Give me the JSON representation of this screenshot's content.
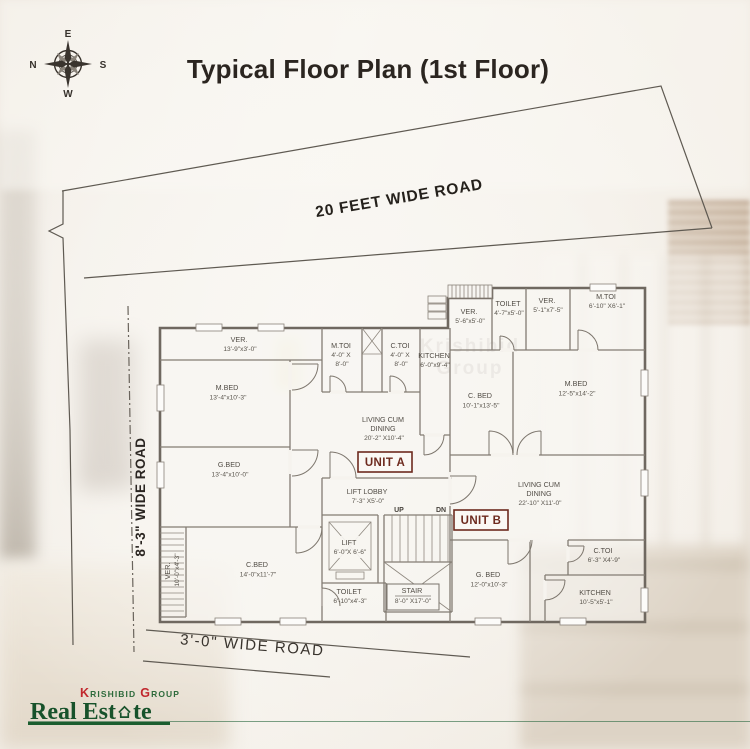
{
  "title": "Typical Floor Plan (1st Floor)",
  "compass": {
    "top": "E",
    "left": "N",
    "right": "S",
    "bottom": "W"
  },
  "roads": {
    "top": "20 FEET WIDE ROAD",
    "left": "8'-3\" WIDE ROAD",
    "bottom": "3'-0\" WIDE ROAD"
  },
  "plan": {
    "unit_a": "UNIT A",
    "unit_b": "UNIT B",
    "up": "UP",
    "dn": "DN",
    "rooms": [
      {
        "lines": [
          "VER.",
          "13'-9\"x3'-0\""
        ]
      },
      {
        "lines": [
          "M.TOI",
          "4'-0\" X",
          "8'-0\""
        ]
      },
      {
        "lines": [
          "C.TOI",
          "4'-0\" X",
          "8'-0\""
        ]
      },
      {
        "lines": [
          "KITCHEN",
          "6'-0\"x9'-4\""
        ]
      },
      {
        "lines": [
          "M.BED",
          "13'-4\"x10'-3\""
        ]
      },
      {
        "lines": [
          "G.BED",
          "13'-4\"x10'-0\""
        ]
      },
      {
        "lines": [
          "VER.",
          "10'-0\"x4'-3\""
        ]
      },
      {
        "lines": [
          "C.BED",
          "14'-0\"x11'-7\""
        ]
      },
      {
        "lines": [
          "TOILET",
          "6'-10\"x4'-3\""
        ]
      },
      {
        "lines": [
          "LIVING CUM",
          "DINING",
          "20'-2\" X10'-4\""
        ]
      },
      {
        "lines": [
          "LIFT LOBBY",
          "7'-3\" X5'-0\""
        ]
      },
      {
        "lines": [
          "LIFT",
          "6'-0\"X 6'-6\""
        ]
      },
      {
        "lines": [
          "STAIR",
          "8'-0\" X17'-0\""
        ]
      },
      {
        "lines": [
          "VER.",
          "5'-6\"x5'-0\""
        ]
      },
      {
        "lines": [
          "TOILET",
          "4'-7\"x5'-0\""
        ]
      },
      {
        "lines": [
          "VER.",
          "5'-1\"x7'-5\""
        ]
      },
      {
        "lines": [
          "M.TOI",
          "6'-10\" X6'-1\""
        ]
      },
      {
        "lines": [
          "C. BED",
          "10'-1\"x13'-5\""
        ]
      },
      {
        "lines": [
          "M.BED",
          "12'-5\"x14'-2\""
        ]
      },
      {
        "lines": [
          "LIVING CUM",
          "DINING",
          "22'-10\" X11'-0\""
        ]
      },
      {
        "lines": [
          "G. BED",
          "12'-0\"x10'-3\""
        ]
      },
      {
        "lines": [
          "C.TOI",
          "6'-3\" X4'-9\""
        ]
      },
      {
        "lines": [
          "KITCHEN",
          "10'-5\"x5'-1\""
        ]
      }
    ]
  },
  "watermark": "Krishibid Group",
  "logo": {
    "k": "K",
    "rishibid": "RISHIBID",
    "g": "G",
    "roup": "ROUP",
    "brand_pre": "Real Est",
    "brand_post": "te"
  },
  "colors": {
    "accent_red": "#c1272d",
    "brand_green": "#1b5e2f",
    "unit_label": "#6d2a1e",
    "plan_line": "#6f6860",
    "title_text": "#2b2520"
  }
}
